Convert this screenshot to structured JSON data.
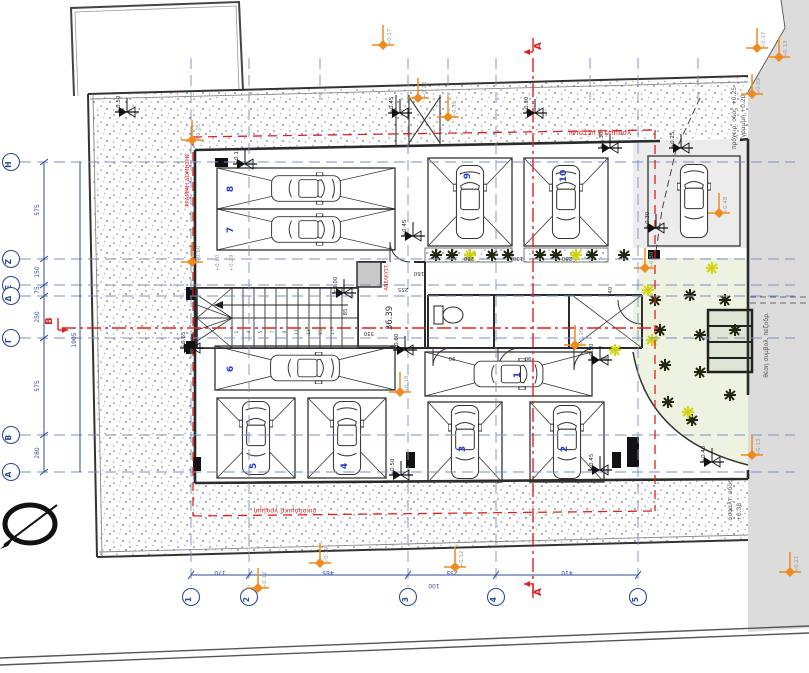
{
  "area_label": "36.39",
  "sections": {
    "a": "Α",
    "b": "Β"
  },
  "red_texts": {
    "building_line_left": "ΓΡΑΜΜΗ ΔΟΜΗΣΗΣ",
    "three_meter_line": "γραμμή 3 μέτρων",
    "building_line_bottom": "οικοδομική γραμμή",
    "elevator": "ΑΝΕΛΚΥΣΤ."
  },
  "street_texts": [
    {
      "v": "πρόχειρ. οδός +0.25",
      "x": 736,
      "y": 118
    },
    {
      "v": "γραμμή +0.20",
      "x": 745,
      "y": 116
    },
    {
      "v": "ασφαλτ. οδός",
      "x": 732,
      "y": 500
    },
    {
      "v": "+0.38",
      "x": 741,
      "y": 512
    },
    {
      "v": "θέση συμβολ. πεζοδρ.",
      "x": 768,
      "y": 345
    }
  ],
  "grid": {
    "letters": [
      {
        "l": "Η",
        "y": 162
      },
      {
        "l": "Ζ",
        "y": 259
      },
      {
        "l": "Ε",
        "y": 285
      },
      {
        "l": "Δ",
        "y": 296
      },
      {
        "l": "Γ",
        "y": 338
      },
      {
        "l": "Β",
        "y": 435
      },
      {
        "l": "Α",
        "y": 472
      }
    ],
    "numbers": [
      {
        "l": "1",
        "x": 191
      },
      {
        "l": "2",
        "x": 249
      },
      {
        "l": "3",
        "x": 408
      },
      {
        "l": "4",
        "x": 496
      },
      {
        "l": "5",
        "x": 638
      }
    ]
  },
  "dims": {
    "left": [
      {
        "v": "575",
        "y": 210
      },
      {
        "v": "150",
        "y": 272
      },
      {
        "v": "75",
        "y": 290
      },
      {
        "v": "250",
        "y": 317
      },
      {
        "v": "575",
        "y": 386
      },
      {
        "v": "280",
        "y": 453
      }
    ],
    "left_total": "1905",
    "bottom": [
      {
        "v": "170",
        "x": 220
      },
      {
        "v": "465",
        "x": 328
      },
      {
        "v": "255",
        "x": 452
      },
      {
        "v": "410",
        "x": 567
      }
    ],
    "bottom_extra": {
      "v": "100",
      "x": 434
    }
  },
  "stalls": [
    {
      "num": "8",
      "x": 217,
      "y": 168,
      "w": 178,
      "h": 41,
      "dir": "h",
      "cross": true,
      "nx": 233,
      "ny": 189
    },
    {
      "num": "7",
      "x": 217,
      "y": 209,
      "w": 178,
      "h": 41,
      "dir": "h",
      "cross": true,
      "nx": 233,
      "ny": 230
    },
    {
      "num": "9",
      "x": 428,
      "y": 158,
      "w": 84,
      "h": 88,
      "dir": "v",
      "cross": true,
      "nx": 470,
      "ny": 176
    },
    {
      "num": "10",
      "x": 524,
      "y": 158,
      "w": 84,
      "h": 88,
      "dir": "v",
      "cross": true,
      "nx": 566,
      "ny": 176
    },
    {
      "num": "",
      "x": 648,
      "y": 156,
      "w": 92,
      "h": 90,
      "dir": "v",
      "cross": false,
      "nx": 0,
      "ny": 0
    },
    {
      "num": "6",
      "x": 215,
      "y": 346,
      "w": 180,
      "h": 44,
      "dir": "h",
      "cross": true,
      "nx": 233,
      "ny": 369
    },
    {
      "num": "5",
      "x": 217,
      "y": 398,
      "w": 78,
      "h": 80,
      "dir": "v",
      "cross": true,
      "nx": 256,
      "ny": 466
    },
    {
      "num": "4",
      "x": 308,
      "y": 398,
      "w": 78,
      "h": 80,
      "dir": "v",
      "cross": true,
      "nx": 347,
      "ny": 466
    },
    {
      "num": "1",
      "x": 425,
      "y": 352,
      "w": 167,
      "h": 44,
      "dir": "h",
      "cross": true,
      "nx": 520,
      "ny": 375
    },
    {
      "num": "3",
      "x": 428,
      "y": 402,
      "w": 74,
      "h": 80,
      "dir": "v",
      "cross": true,
      "nx": 465,
      "ny": 449
    },
    {
      "num": "2",
      "x": 530,
      "y": 402,
      "w": 74,
      "h": 80,
      "dir": "v",
      "cross": true,
      "nx": 567,
      "ny": 449
    }
  ],
  "levels": [
    {
      "x": 383,
      "y": 45,
      "c": "o",
      "l": "+0.17"
    },
    {
      "x": 757,
      "y": 48,
      "c": "o",
      "l": "+0.17"
    },
    {
      "x": 779,
      "y": 57,
      "c": "o",
      "l": "+0.13"
    },
    {
      "x": 752,
      "y": 94,
      "c": "o",
      "l": "+0.02"
    },
    {
      "x": 418,
      "y": 98,
      "c": "o",
      "l": "+0.23"
    },
    {
      "x": 448,
      "y": 117,
      "c": "o",
      "l": "+0.35"
    },
    {
      "x": 192,
      "y": 140,
      "c": "o",
      "l": "+0.05"
    },
    {
      "x": 192,
      "y": 262,
      "c": "o",
      "l": "+0.60"
    },
    {
      "x": 400,
      "y": 392,
      "c": "o",
      "l": "+0.18"
    },
    {
      "x": 575,
      "y": 345,
      "c": "o",
      "l": "+0.10"
    },
    {
      "x": 719,
      "y": 213,
      "c": "o",
      "l": "+0.48"
    },
    {
      "x": 645,
      "y": 268,
      "c": "o",
      "l": "+0.30"
    },
    {
      "x": 752,
      "y": 455,
      "c": "o",
      "l": "+0.13"
    },
    {
      "x": 790,
      "y": 572,
      "c": "o",
      "l": "+0.21"
    },
    {
      "x": 455,
      "y": 567,
      "c": "o",
      "l": "+0.12"
    },
    {
      "x": 320,
      "y": 563,
      "c": "o",
      "l": "+0.19"
    },
    {
      "x": 258,
      "y": 588,
      "c": "o",
      "l": "+0.12"
    },
    {
      "x": 127,
      "y": 112,
      "c": "b",
      "l": "+0.50"
    },
    {
      "x": 245,
      "y": 164,
      "c": "b",
      "l": "+0.15"
    },
    {
      "x": 400,
      "y": 113,
      "c": "b",
      "l": "+0.45"
    },
    {
      "x": 535,
      "y": 113,
      "c": "b",
      "l": "+0.30"
    },
    {
      "x": 610,
      "y": 148,
      "c": "b",
      "l": "+0.30"
    },
    {
      "x": 681,
      "y": 148,
      "c": "b",
      "l": "+0.25"
    },
    {
      "x": 413,
      "y": 236,
      "c": "b",
      "l": "+0.45"
    },
    {
      "x": 656,
      "y": 228,
      "c": "b",
      "l": "+0.30"
    },
    {
      "x": 344,
      "y": 293,
      "c": "b",
      "l": "±0.00"
    },
    {
      "x": 192,
      "y": 348,
      "c": "b",
      "l": "+0.65"
    },
    {
      "x": 405,
      "y": 350,
      "c": "b",
      "l": "+0.60"
    },
    {
      "x": 600,
      "y": 360,
      "c": "b",
      "l": "+0.50"
    },
    {
      "x": 401,
      "y": 475,
      "c": "b",
      "l": "+0.50"
    },
    {
      "x": 600,
      "y": 470,
      "c": "b",
      "l": "+0.45"
    },
    {
      "x": 712,
      "y": 462,
      "c": "b",
      "l": "+0.40"
    }
  ],
  "small_labels": [
    {
      "v": "+0.60",
      "x": 219,
      "y": 263
    },
    {
      "v": "+0.29",
      "x": 233,
      "y": 263
    }
  ],
  "interior_dims": [
    {
      "v": "160",
      "x": 419,
      "y": 272,
      "r": 180
    },
    {
      "v": "255",
      "x": 403,
      "y": 288,
      "r": 180
    },
    {
      "v": "330",
      "x": 369,
      "y": 332,
      "r": 180
    },
    {
      "v": "85",
      "x": 347,
      "y": 312,
      "r": -90
    },
    {
      "v": "140",
      "x": 612,
      "y": 292,
      "r": -90
    },
    {
      "v": "280",
      "x": 469,
      "y": 257,
      "r": 180
    },
    {
      "v": "130",
      "x": 518,
      "y": 257,
      "r": 180
    },
    {
      "v": "280",
      "x": 567,
      "y": 257,
      "r": 180
    },
    {
      "v": "90",
      "x": 452,
      "y": 357,
      "r": 180
    },
    {
      "v": "90",
      "x": 528,
      "y": 357,
      "r": 180
    },
    {
      "v": "90",
      "x": 604,
      "y": 357,
      "r": 180
    }
  ],
  "stair_numbers": [
    "1",
    "3",
    "5",
    "7",
    "9",
    "11",
    "13",
    "15",
    "17"
  ],
  "plants": [
    {
      "x": 436,
      "y": 255,
      "t": "d"
    },
    {
      "x": 452,
      "y": 255,
      "t": "d"
    },
    {
      "x": 470,
      "y": 255,
      "t": "y"
    },
    {
      "x": 492,
      "y": 255,
      "t": "d"
    },
    {
      "x": 508,
      "y": 255,
      "t": "d"
    },
    {
      "x": 540,
      "y": 255,
      "t": "d"
    },
    {
      "x": 556,
      "y": 255,
      "t": "d"
    },
    {
      "x": 576,
      "y": 255,
      "t": "y"
    },
    {
      "x": 592,
      "y": 255,
      "t": "d"
    },
    {
      "x": 624,
      "y": 255,
      "t": "d"
    },
    {
      "x": 655,
      "y": 300,
      "t": "d"
    },
    {
      "x": 690,
      "y": 295,
      "t": "d"
    },
    {
      "x": 725,
      "y": 300,
      "t": "d"
    },
    {
      "x": 660,
      "y": 330,
      "t": "d"
    },
    {
      "x": 700,
      "y": 335,
      "t": "d"
    },
    {
      "x": 735,
      "y": 330,
      "t": "d"
    },
    {
      "x": 665,
      "y": 365,
      "t": "d"
    },
    {
      "x": 700,
      "y": 372,
      "t": "d"
    },
    {
      "x": 730,
      "y": 395,
      "t": "d"
    },
    {
      "x": 668,
      "y": 402,
      "t": "d"
    },
    {
      "x": 692,
      "y": 420,
      "t": "d"
    },
    {
      "x": 648,
      "y": 290,
      "t": "y"
    },
    {
      "x": 652,
      "y": 340,
      "t": "y"
    },
    {
      "x": 712,
      "y": 268,
      "t": "y"
    },
    {
      "x": 615,
      "y": 350,
      "t": "y"
    },
    {
      "x": 688,
      "y": 412,
      "t": "y"
    }
  ],
  "colors": {
    "grid_blue": "#7b8fc0",
    "dim_blue": "#2d4b9b",
    "red": "#e02020",
    "orange": "#f08a1d",
    "green": "#0d7d33",
    "yellow": "#e3e31a",
    "street": "#dcdcdc",
    "wall": "#2b2b2b",
    "car_number": "#2a3bd0"
  }
}
